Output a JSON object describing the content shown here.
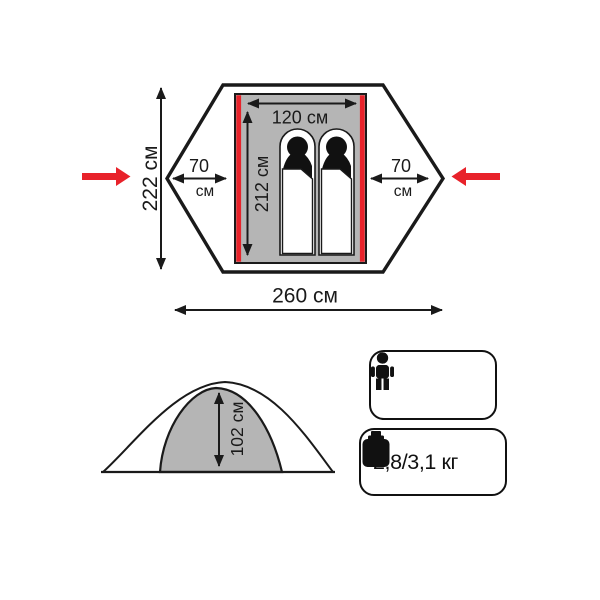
{
  "top_view": {
    "total_depth_label": "222 см",
    "total_width_label": "260 см",
    "inner_width_label": "120 см",
    "inner_length_label": "212 см",
    "vestibule_left": {
      "value": "70",
      "unit": "см"
    },
    "vestibule_right": {
      "value": "70",
      "unit": "см"
    },
    "entrance_icons": [
      "entrance-arrow-left-icon",
      "entrance-arrow-right-icon"
    ],
    "sleeping_spots": 2
  },
  "side_view": {
    "peak_height_label": "102 см"
  },
  "badges": {
    "capacity": {
      "icon": "person-icon",
      "person_count": 2
    },
    "weight": {
      "icon": "weight-icon",
      "label": "2,8/3,1 кг"
    }
  },
  "colors": {
    "accent_red": "#e8222a",
    "floor_gray": "#b5b5b5",
    "line_black": "#1a1a1a"
  }
}
